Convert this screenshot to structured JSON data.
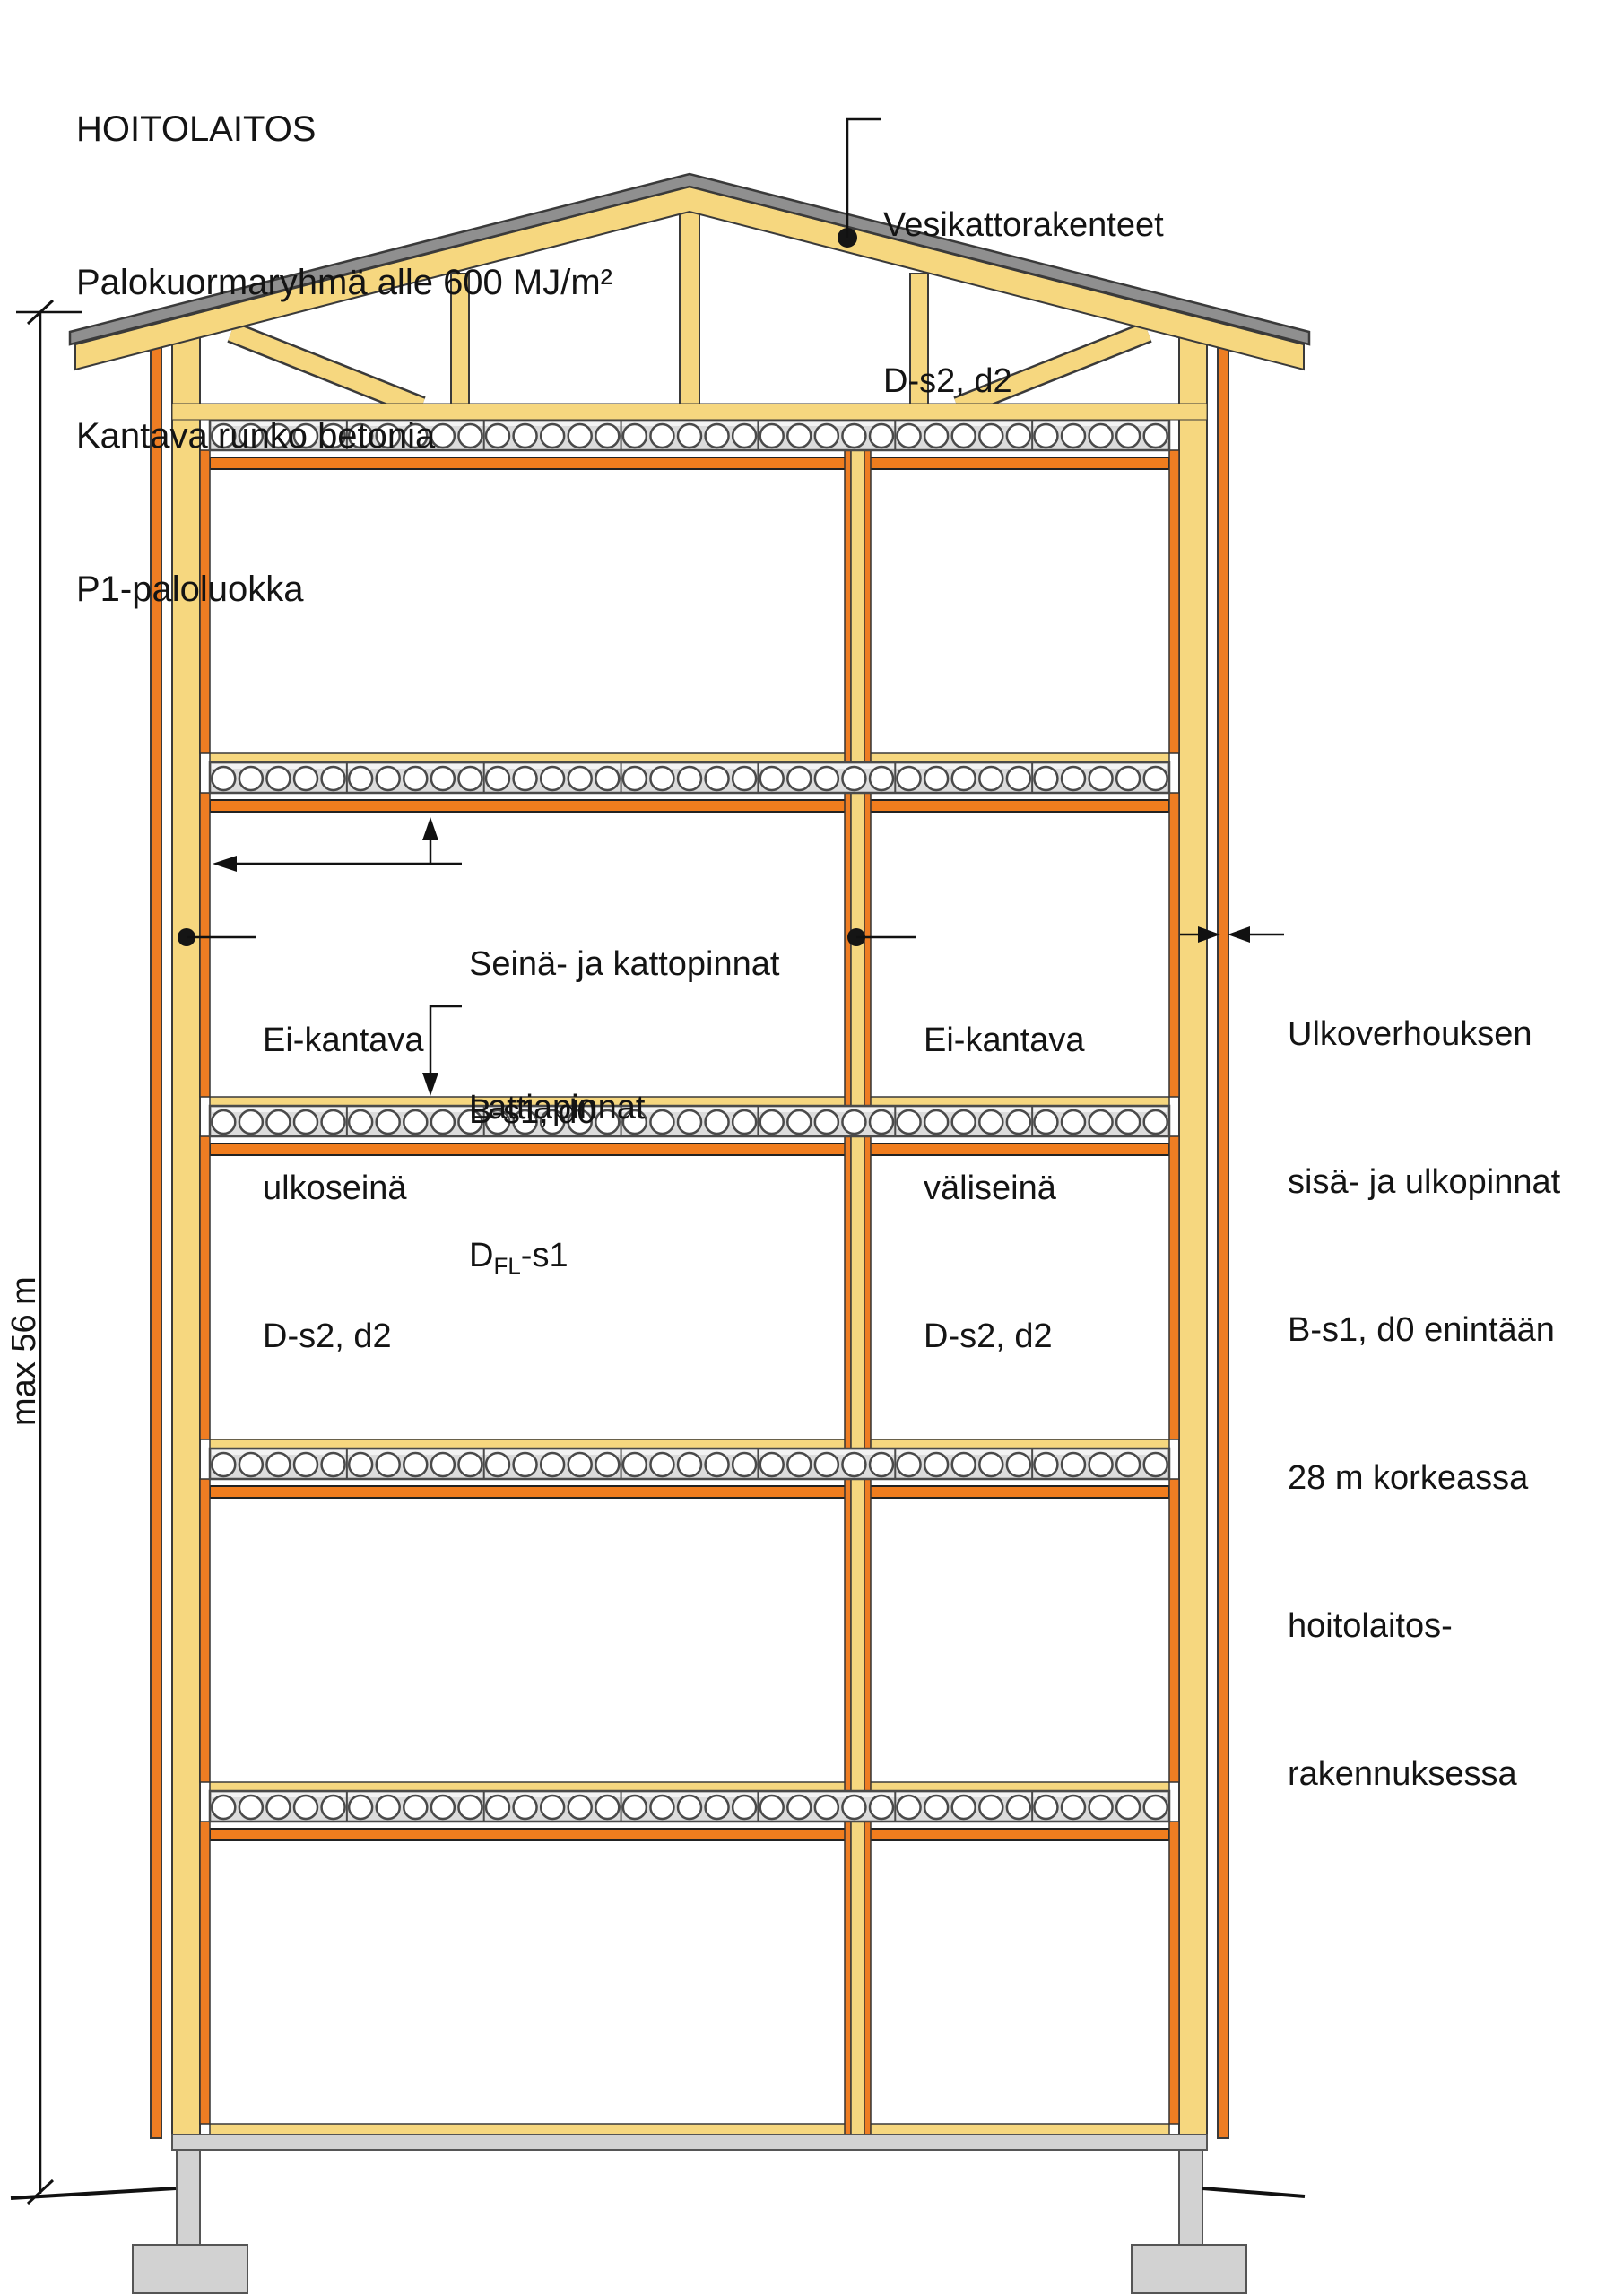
{
  "title": {
    "line1": "HOITOLAITOS",
    "line2": "Palokuormaryhmä alle 600 MJ/m²",
    "line3": "Kantava runko betonia",
    "line4": "P1-paloluokka"
  },
  "labels": {
    "roof_structures": {
      "line1": "Vesikattorakenteet",
      "line2": "D-s2, d2"
    },
    "wall_ceiling_surfaces": {
      "line1": "Seinä- ja kattopinnat",
      "line2": "B-s1, d0"
    },
    "floor_surfaces": {
      "line1": "Lattiapinnat",
      "class_main": "D",
      "class_sub": "FL",
      "class_rest": "-s1"
    },
    "exterior_wall": {
      "line1": "Ei-kantava",
      "line2": "ulkoseinä",
      "line3": "D-s2, d2"
    },
    "partition_wall": {
      "line1": "Ei-kantava",
      "line2": "väliseinä",
      "line3": "D-s2, d2"
    },
    "cladding": {
      "line1": "Ulkoverhouksen",
      "line2": "sisä- ja ulkopinnat",
      "line3": "B-s1, d0 enintään",
      "line4": "28 m korkeassa",
      "line5": "hoitolaitos-",
      "line6": "rakennuksessa"
    },
    "max_height": "max 56 m"
  },
  "colors": {
    "wood": "#F6D77F",
    "orange": "#EE7D23",
    "ceiling": "#F07D1E",
    "slab": "#DCDCDC",
    "roof": "#8F8F8F",
    "foundation": "#D2D2D2",
    "ink": "#141414",
    "bg": "#FFFFFF"
  }
}
